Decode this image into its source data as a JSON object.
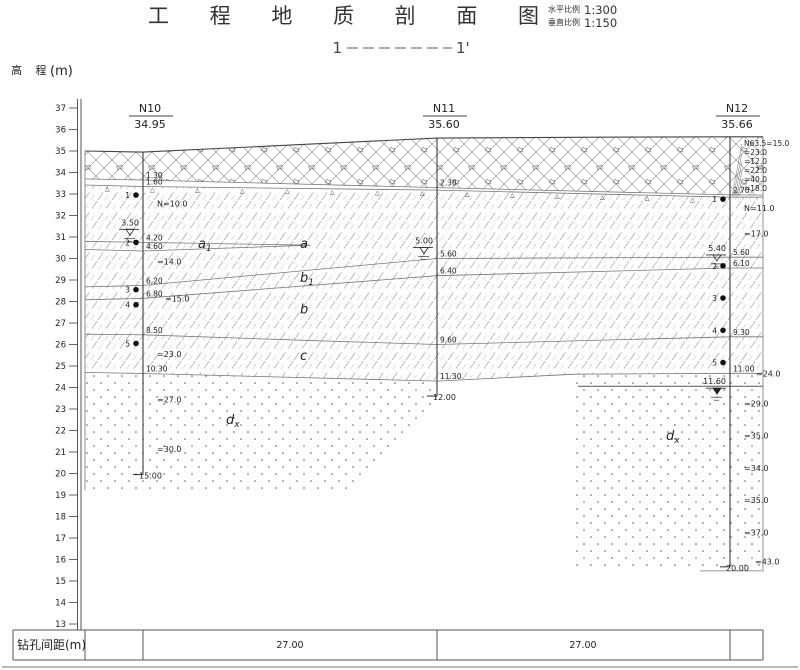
{
  "title": "工 程 地 质 剖 面 图",
  "scales": {
    "horizontal_label": "水平比例",
    "horizontal_value": "1:300",
    "vertical_label": "垂直比例",
    "vertical_value": "1:150"
  },
  "section": {
    "start": "1",
    "end": "1'"
  },
  "elevation_axis": {
    "label": "高 程",
    "unit": "(m)",
    "ticks": [
      37,
      36,
      35,
      34,
      33,
      32,
      31,
      30,
      29,
      28,
      27,
      26,
      25,
      24,
      23,
      22,
      21,
      20,
      19,
      18,
      17,
      16,
      15,
      14,
      13
    ]
  },
  "spacing_table": {
    "row_label": "钻孔间距(m)",
    "values": [
      "27.00",
      "27.00"
    ]
  },
  "boreholes": [
    {
      "name": "N10",
      "top_elevation": 34.95,
      "x": 143,
      "end_depth": 15.0,
      "end_label": "15.00",
      "depth_marks": [
        "1.30",
        "1.60",
        "4.20",
        "4.60",
        "6.20",
        "6.80",
        "8.50",
        "10.30"
      ],
      "depth_vals": [
        1.3,
        1.6,
        4.2,
        4.6,
        6.2,
        6.8,
        8.5,
        10.3
      ],
      "water_levels": [
        {
          "label": "3.50",
          "depth": 3.5,
          "type": "phreatic"
        }
      ],
      "n_values": [
        {
          "label": "N=10.0",
          "depth": 2.4
        },
        {
          "label": "=14.0",
          "depth": 5.1
        },
        {
          "label": "=15.0",
          "depth": 6.8,
          "dx": 22
        },
        {
          "label": "=23.0",
          "depth": 9.4
        },
        {
          "label": "=27.0",
          "depth": 11.5
        },
        {
          "label": "=30.0",
          "depth": 13.8
        }
      ],
      "samples": [
        {
          "no": "1",
          "depth": 2.0
        },
        {
          "no": "2",
          "depth": 4.2
        },
        {
          "no": "3",
          "depth": 6.4
        },
        {
          "no": "4",
          "depth": 7.1
        },
        {
          "no": "5",
          "depth": 8.9
        }
      ]
    },
    {
      "name": "N11",
      "top_elevation": 35.6,
      "x": 437,
      "end_depth": 12.0,
      "end_label": "12.00",
      "depth_marks": [
        "2.30",
        "5.60",
        "6.40",
        "9.60",
        "11.30"
      ],
      "depth_vals": [
        2.3,
        5.6,
        6.4,
        9.6,
        11.3
      ],
      "water_levels": [
        {
          "label": "5.00",
          "depth": 5.0,
          "type": "phreatic"
        }
      ],
      "n_values": [],
      "samples": []
    },
    {
      "name": "N12",
      "top_elevation": 35.66,
      "x": 730,
      "end_depth": 20.0,
      "end_label": "20.00",
      "depth_marks": [
        "2.70",
        "5.60",
        "6.10",
        "9.30",
        "11.00"
      ],
      "depth_vals": [
        2.7,
        5.6,
        6.1,
        9.3,
        11.0
      ],
      "water_levels": [
        {
          "label": "5.40",
          "depth": 5.4,
          "type": "phreatic"
        },
        {
          "label": "11.60",
          "depth": 11.6,
          "type": "confined"
        }
      ],
      "n_values": [
        {
          "label": "N=11.0",
          "depth": 3.3
        },
        {
          "label": "=17.0",
          "depth": 4.5
        },
        {
          "label": "=24.0",
          "depth": 11.0,
          "dx": 26
        },
        {
          "label": "=29.0",
          "depth": 12.4
        },
        {
          "label": "=35.0",
          "depth": 13.9
        },
        {
          "label": "=34.0",
          "depth": 15.4
        },
        {
          "label": "=35.0",
          "depth": 16.9
        },
        {
          "label": "=37.0",
          "depth": 18.4
        },
        {
          "label": "=43.0",
          "depth": 19.75,
          "dx": 25
        }
      ],
      "samples": [
        {
          "no": "1",
          "depth": 2.9
        },
        {
          "no": "2",
          "depth": 6.0
        },
        {
          "no": "3",
          "depth": 7.5
        },
        {
          "no": "4",
          "depth": 9.0
        },
        {
          "no": "5",
          "depth": 10.5
        }
      ],
      "top_n_column": [
        "N63.5=15.0",
        "=23.0",
        "=12.0",
        "=22.0",
        "=40.0",
        "=18.0"
      ]
    }
  ],
  "layer_labels": [
    {
      "text": "a",
      "sub": "1",
      "x": 198,
      "elev": 30.49
    },
    {
      "text": "a",
      "x": 300,
      "elev": 30.49
    },
    {
      "text": "b",
      "sub": "1",
      "x": 300,
      "elev": 28.91
    },
    {
      "text": "b",
      "x": 300,
      "elev": 27.45
    },
    {
      "text": "c",
      "x": 300,
      "elev": 25.28
    },
    {
      "text": "d",
      "sub": "x",
      "x": 226,
      "elev": 22.3
    },
    {
      "text": "d",
      "sub": "x",
      "x": 666,
      "elev": 21.55
    }
  ],
  "geometry": {
    "regions": [
      {
        "name": "fill-layer",
        "pattern": "crosshatch",
        "points": [
          [
            85,
            35.0
          ],
          [
            143,
            34.95
          ],
          [
            300,
            35.3
          ],
          [
            437,
            35.6
          ],
          [
            600,
            35.64
          ],
          [
            730,
            35.66
          ],
          [
            763,
            35.66
          ],
          [
            763,
            32.95
          ],
          [
            730,
            32.96
          ],
          [
            437,
            33.3
          ],
          [
            143,
            33.65
          ],
          [
            85,
            33.7
          ]
        ]
      },
      {
        "name": "clay-layer",
        "pattern": "hatch",
        "points": [
          [
            85,
            33.42
          ],
          [
            143,
            33.35
          ],
          [
            437,
            33.18
          ],
          [
            730,
            32.85
          ],
          [
            763,
            32.85
          ],
          [
            763,
            24.66
          ],
          [
            730,
            24.66
          ],
          [
            575,
            24.62
          ],
          [
            437,
            24.3
          ],
          [
            143,
            24.65
          ],
          [
            85,
            24.7
          ]
        ]
      },
      {
        "name": "sand-layer-left",
        "pattern": "dots",
        "points": [
          [
            85,
            24.7
          ],
          [
            143,
            24.65
          ],
          [
            437,
            24.3
          ],
          [
            437,
            23.33
          ],
          [
            350,
            19.23
          ],
          [
            85,
            19.23
          ]
        ]
      },
      {
        "name": "sand-layer-right",
        "pattern": "dots",
        "points": [
          [
            575,
            24.62
          ],
          [
            730,
            24.66
          ],
          [
            763,
            24.66
          ],
          [
            763,
            15.45
          ],
          [
            575,
            15.45
          ]
        ]
      }
    ],
    "boundaries": [
      {
        "name": "ground-surface",
        "w": 1.1,
        "c": "#444",
        "points": [
          [
            85,
            35.0
          ],
          [
            143,
            34.95
          ],
          [
            300,
            35.3
          ],
          [
            437,
            35.6
          ],
          [
            600,
            35.64
          ],
          [
            730,
            35.66
          ],
          [
            763,
            35.66
          ]
        ]
      },
      {
        "name": "fill-bottom",
        "points": [
          [
            85,
            33.7
          ],
          [
            143,
            33.65
          ],
          [
            437,
            33.3
          ],
          [
            730,
            32.96
          ],
          [
            763,
            32.95
          ]
        ]
      },
      {
        "name": "fill-bottom-2",
        "points": [
          [
            85,
            33.42
          ],
          [
            143,
            33.35
          ],
          [
            437,
            33.18
          ],
          [
            730,
            32.85
          ],
          [
            763,
            32.85
          ]
        ]
      },
      {
        "name": "lens-top",
        "points": [
          [
            85,
            30.8
          ],
          [
            143,
            30.75
          ],
          [
            310,
            30.62
          ]
        ]
      },
      {
        "name": "lens-bottom",
        "points": [
          [
            85,
            30.42
          ],
          [
            143,
            30.35
          ],
          [
            310,
            30.62
          ]
        ]
      },
      {
        "name": "a-b1-boundary",
        "points": [
          [
            85,
            28.68
          ],
          [
            143,
            28.75
          ],
          [
            437,
            30.0
          ],
          [
            730,
            30.06
          ],
          [
            763,
            30.06
          ]
        ]
      },
      {
        "name": "b1-b-boundary",
        "points": [
          [
            85,
            28.08
          ],
          [
            143,
            28.15
          ],
          [
            437,
            29.2
          ],
          [
            730,
            29.56
          ],
          [
            763,
            29.56
          ]
        ]
      },
      {
        "name": "b-c-boundary",
        "points": [
          [
            85,
            26.48
          ],
          [
            143,
            26.45
          ],
          [
            300,
            26.2
          ],
          [
            437,
            26.0
          ],
          [
            730,
            26.36
          ],
          [
            763,
            26.36
          ]
        ]
      },
      {
        "name": "c-d-boundary",
        "points": [
          [
            85,
            24.7
          ],
          [
            143,
            24.65
          ],
          [
            437,
            24.3
          ],
          [
            575,
            24.62
          ],
          [
            730,
            24.66
          ],
          [
            763,
            24.66
          ]
        ]
      },
      {
        "name": "confined-water-line",
        "w": 1.0,
        "c": "#555",
        "points": [
          [
            578,
            24.06
          ],
          [
            763,
            24.06
          ]
        ]
      },
      {
        "name": "left-edge",
        "points": [
          [
            85,
            35.0
          ],
          [
            85,
            19.23
          ]
        ]
      },
      {
        "name": "right-edge",
        "points": [
          [
            763,
            35.66
          ],
          [
            763,
            15.45
          ]
        ]
      },
      {
        "name": "bottom-right-line",
        "points": [
          [
            700,
            15.47
          ],
          [
            763,
            15.47
          ]
        ]
      }
    ]
  }
}
